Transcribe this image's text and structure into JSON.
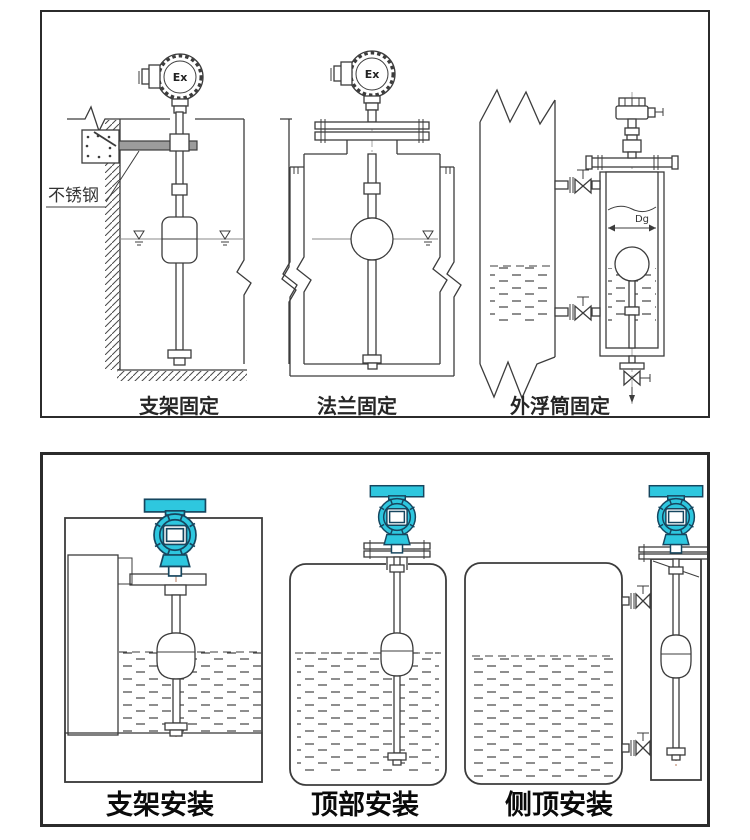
{
  "colors": {
    "accent": "#2EC7DF",
    "accent_outline": "#16465F",
    "line": "#3C3C3C",
    "centerline_red": "#B06A4A"
  },
  "top_panel": {
    "drawings": [
      {
        "id": "bracket-fixing",
        "caption": "支架固定",
        "labels": {
          "material": "不锈钢",
          "head": "Ex"
        }
      },
      {
        "id": "flange-fixing",
        "caption": "法兰固定",
        "labels": {
          "head": "Ex"
        }
      },
      {
        "id": "external-chamber-fixing",
        "caption": "外浮筒固定",
        "labels": {
          "dimension": "Dg"
        }
      }
    ]
  },
  "bottom_panel": {
    "drawings": [
      {
        "id": "bracket-install",
        "caption": "支架安装"
      },
      {
        "id": "top-install",
        "caption": "顶部安装"
      },
      {
        "id": "side-top-install",
        "caption": "侧顶安装"
      }
    ]
  }
}
